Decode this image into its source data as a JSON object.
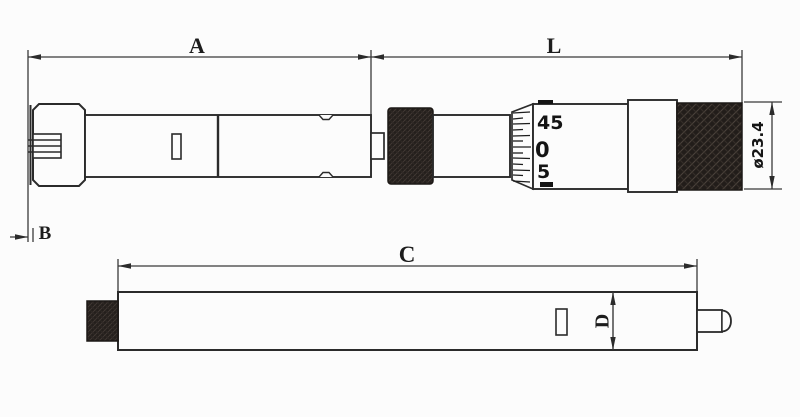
{
  "diagram": {
    "type": "technical-drawing",
    "views": "two side views of an inside micrometer",
    "top_view": {
      "dim_left_span": "A",
      "dim_right_span": "L",
      "dim_head": "B",
      "dim_diameter": "ø23.4",
      "thimble_scale": {
        "numbers": [
          "45",
          "0",
          "5"
        ]
      }
    },
    "bottom_view": {
      "dim_length": "C",
      "dim_diameter": "D"
    }
  },
  "colors": {
    "background": "#fcfcfc",
    "ink": "#2b2b2b",
    "dimension_line": "#3a3a3a",
    "knurl_dark": "#221d1a",
    "knurl_highlight": "#49403a"
  }
}
